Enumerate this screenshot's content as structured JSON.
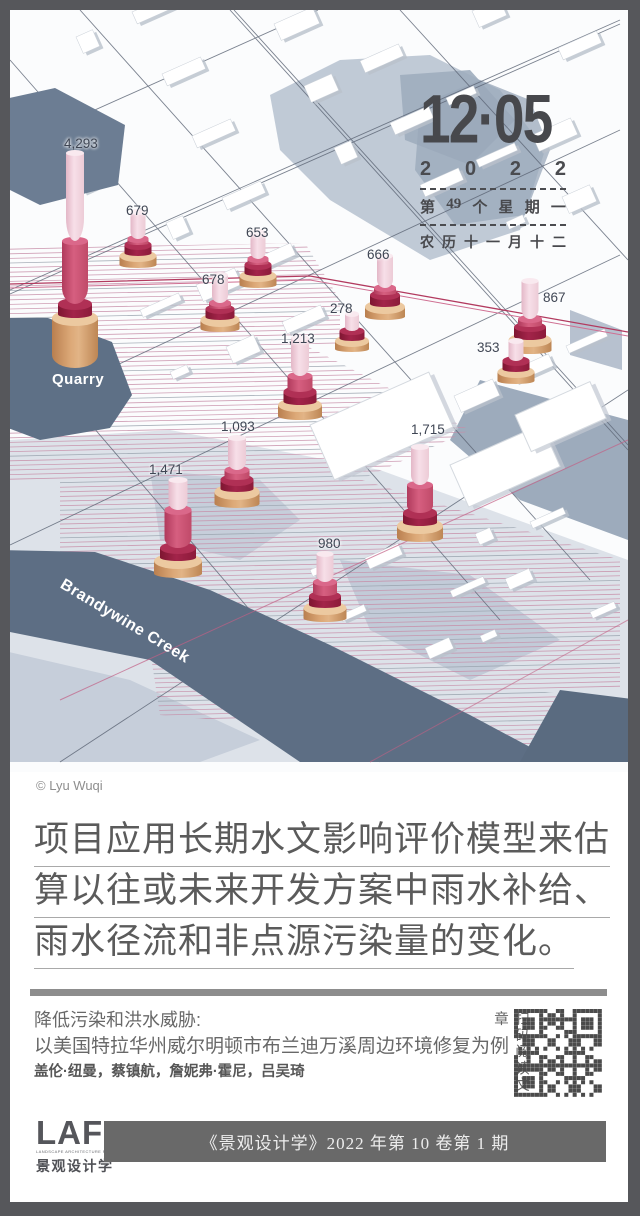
{
  "poster": {
    "credit": "© Lyu Wuqi"
  },
  "date_block": {
    "day": "12·05",
    "year": [
      "2",
      "0",
      "2",
      "2"
    ],
    "week": [
      "第",
      "49",
      "个",
      "星",
      "期",
      "一"
    ],
    "lunar": [
      "农",
      "历",
      "十",
      "一",
      "月",
      "十",
      "二"
    ]
  },
  "map": {
    "place_labels": {
      "quarry": "Quarry",
      "creek": "Brandywine Creek"
    },
    "columns": [
      {
        "value": "4,293",
        "x": 75,
        "y": 368,
        "w": 46,
        "tan": 50,
        "dark": 14,
        "mid": 63,
        "pink": 88,
        "lx": 64,
        "ly": 136
      },
      {
        "value": "679",
        "x": 138,
        "y": 268,
        "w": 37,
        "tan": 12,
        "dark": 11,
        "mid": 6,
        "pink": 27,
        "lx": 126,
        "ly": 203
      },
      {
        "value": "653",
        "x": 258,
        "y": 288,
        "w": 37,
        "tan": 12,
        "dark": 11,
        "mid": 6,
        "pink": 27,
        "lx": 246,
        "ly": 225
      },
      {
        "value": "678",
        "x": 220,
        "y": 332,
        "w": 39,
        "tan": 12,
        "dark": 11,
        "mid": 6,
        "pink": 28,
        "lx": 202,
        "ly": 272
      },
      {
        "value": "666",
        "x": 385,
        "y": 320,
        "w": 40,
        "tan": 13,
        "dark": 12,
        "mid": 7,
        "pink": 32,
        "lx": 367,
        "ly": 247
      },
      {
        "value": "278",
        "x": 352,
        "y": 352,
        "w": 34,
        "tan": 11,
        "dark": 10,
        "mid": 0,
        "pink": 17,
        "lx": 330,
        "ly": 301
      },
      {
        "value": "867",
        "x": 530,
        "y": 354,
        "w": 43,
        "tan": 14,
        "dark": 13,
        "mid": 8,
        "pink": 38,
        "lx": 543,
        "ly": 290
      },
      {
        "value": "353",
        "x": 516,
        "y": 384,
        "w": 37,
        "tan": 12,
        "dark": 11,
        "mid": 0,
        "pink": 20,
        "lx": 477,
        "ly": 340
      },
      {
        "value": "1,213",
        "x": 300,
        "y": 420,
        "w": 44,
        "tan": 15,
        "dark": 13,
        "mid": 16,
        "pink": 38,
        "lx": 281,
        "ly": 331
      },
      {
        "value": "1,093",
        "x": 237,
        "y": 508,
        "w": 45,
        "tan": 16,
        "dark": 12,
        "mid": 10,
        "pink": 32,
        "lx": 221,
        "ly": 419
      },
      {
        "value": "1,471",
        "x": 178,
        "y": 578,
        "w": 48,
        "tan": 17,
        "dark": 13,
        "mid": 38,
        "pink": 30,
        "lx": 149,
        "ly": 462
      },
      {
        "value": "1,715",
        "x": 420,
        "y": 542,
        "w": 46,
        "tan": 16,
        "dark": 13,
        "mid": 28,
        "pink": 38,
        "lx": 411,
        "ly": 422
      },
      {
        "value": "980",
        "x": 325,
        "y": 622,
        "w": 43,
        "tan": 14,
        "dark": 12,
        "mid": 14,
        "pink": 28,
        "lx": 318,
        "ly": 536
      }
    ]
  },
  "summary": {
    "lines": [
      "项目应用长期水文影响评价模型来估",
      "算以往或未来开发方案中雨水补给、",
      "雨水径流和非点源污染量的变化。"
    ]
  },
  "article": {
    "title_line1": "降低污染和洪水威胁:",
    "title_line2": "以美国特拉华州威尔明顿市布兰迪万溪周边环境修复为例",
    "authors": "盖伦·纽曼，蔡镇航，詹妮弗·霍尼，吕吴琦",
    "qr_caption": "扫码阅读文章"
  },
  "footer": {
    "logo": "LAF",
    "logo_sub": "LANDSCAPE ARCHITECTURE FRONTIERS",
    "logo_cn": "景观设计学",
    "issue": "《景观设计学》2022 年第 10 卷第 1 期"
  },
  "colors": {
    "accent_crimson": "#a3244a",
    "accent_pink": "#f2d3de",
    "base_tan": "#d7a273",
    "water_dark": "#5d6e84",
    "water_light": "#c6ceda",
    "frame": "#56575b"
  },
  "chart_data": {
    "type": "bar",
    "title": "",
    "values": [
      4293,
      679,
      653,
      678,
      666,
      278,
      867,
      353,
      1213,
      1093,
      1471,
      1715,
      980
    ],
    "annotations": [
      "Quarry",
      "Brandywine Creek"
    ]
  }
}
